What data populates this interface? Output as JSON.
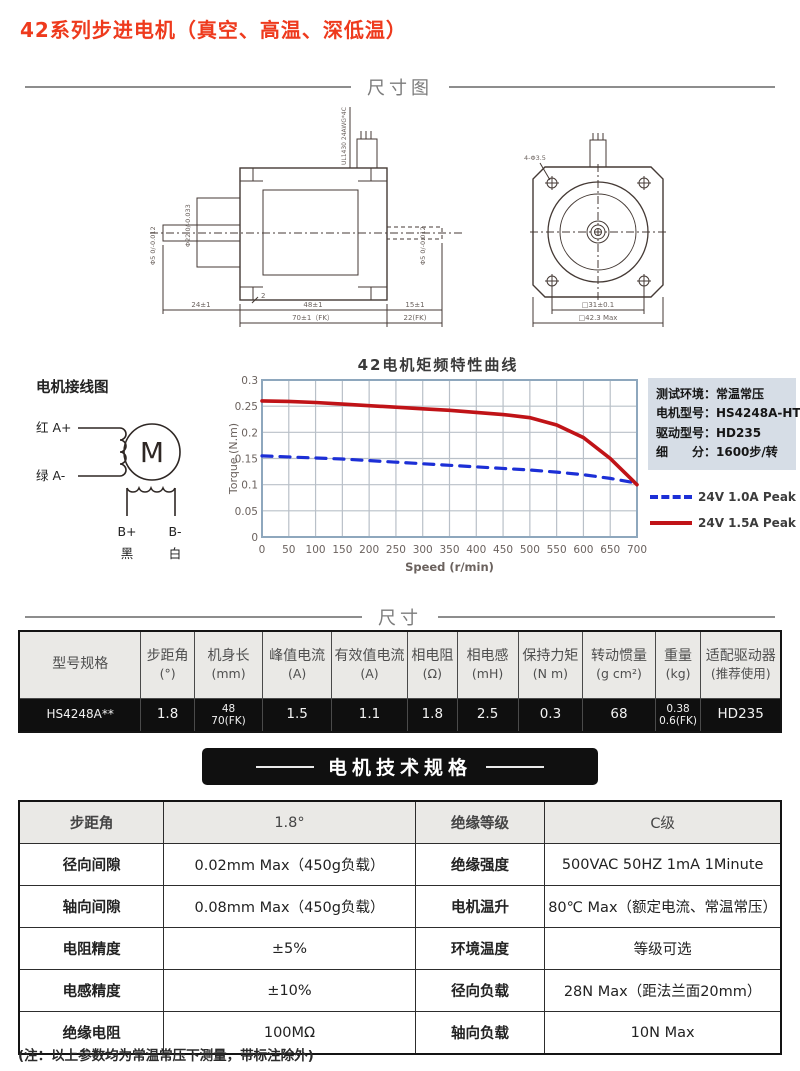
{
  "page_title": "42系列步进电机（真空、高温、深低温）",
  "accent_color": "#ee3a1d",
  "sections": {
    "dimension_diagram": "尺寸图",
    "dimensions": "尺寸",
    "specs": "电机技术规格"
  },
  "drawing": {
    "cable_label": "UL1430 24AWG*4C",
    "side_view": {
      "shaft_dia": "Φ5 0/-0.012",
      "pilot_dia": "Φ22 0/-0.033",
      "rear_shaft_dia": "Φ5 0/-0.012",
      "boss_len": "2",
      "front_shaft_len": "24±1",
      "body_len": "48±1",
      "body_len_fk": "70±1（FK）",
      "rear_shaft_len": "15±1",
      "rear_shaft_len_fk": "22(FK)"
    },
    "front_view": {
      "mounting_holes": "4-Φ3.5",
      "hole_pitch": "□31±0.1",
      "flange_size": "□42.3 Max"
    }
  },
  "wiring": {
    "title": "电机接线图",
    "a_plus": "红 A+",
    "a_minus": "绿 A-",
    "motor": "M",
    "b_plus": "B+",
    "b_minus": "B-",
    "black": "黑",
    "white": "白"
  },
  "info_panel": {
    "line1": "测试环境：常温常压",
    "line2": "电机型号：HS4248A-HT",
    "line3": "驱动型号：HD235",
    "line4": "细　　分：1600步/转"
  },
  "chart_data": {
    "type": "line",
    "title": "42电机矩频特性曲线",
    "xlabel": "Speed (r/min)",
    "ylabel": "Torque (N.m)",
    "xlim": [
      0,
      700
    ],
    "ylim": [
      0,
      0.3
    ],
    "x_ticks": [
      0,
      50,
      100,
      150,
      200,
      250,
      300,
      350,
      400,
      450,
      500,
      550,
      600,
      650,
      700
    ],
    "y_ticks": [
      0,
      0.05,
      0.1,
      0.15,
      0.2,
      0.25,
      0.3
    ],
    "grid": true,
    "legend_position": "right-bottom",
    "x": [
      0,
      50,
      100,
      150,
      200,
      250,
      300,
      350,
      400,
      450,
      500,
      550,
      600,
      650,
      700
    ],
    "series": [
      {
        "name": "24V 1.0A Peak",
        "color": "#1c2fd6",
        "style": "dashed",
        "values": [
          0.155,
          0.153,
          0.151,
          0.149,
          0.146,
          0.143,
          0.14,
          0.137,
          0.134,
          0.131,
          0.128,
          0.124,
          0.119,
          0.112,
          0.103
        ]
      },
      {
        "name": "24V 1.5A Peak",
        "color": "#c01317",
        "style": "solid",
        "values": [
          0.26,
          0.259,
          0.257,
          0.254,
          0.251,
          0.248,
          0.245,
          0.242,
          0.238,
          0.234,
          0.228,
          0.214,
          0.19,
          0.15,
          0.1
        ]
      }
    ]
  },
  "size_table": {
    "columns": [
      {
        "label": "型号规格",
        "unit": ""
      },
      {
        "label": "步距角",
        "unit": "(°)"
      },
      {
        "label": "机身长",
        "unit": "(mm)"
      },
      {
        "label": "峰值电流",
        "unit": "(A)"
      },
      {
        "label": "有效值电流",
        "unit": "(A)"
      },
      {
        "label": "相电阻",
        "unit": "(Ω)"
      },
      {
        "label": "相电感",
        "unit": "(mH)"
      },
      {
        "label": "保持力矩",
        "unit": "(N m)"
      },
      {
        "label": "转动惯量",
        "unit": "(g cm²)"
      },
      {
        "label": "重量",
        "unit": "(kg)"
      },
      {
        "label": "适配驱动器",
        "unit": "(推荐使用)"
      }
    ],
    "row": {
      "model": "HS4248A**",
      "step_angle": "1.8",
      "body_length": "48\n70(FK)",
      "peak_current": "1.5",
      "rms_current": "1.1",
      "phase_resistance": "1.8",
      "phase_inductance": "2.5",
      "holding_torque": "0.3",
      "rotor_inertia": "68",
      "weight": "0.38\n0.6(FK)",
      "driver": "HD235"
    }
  },
  "spec_table": {
    "rows": [
      {
        "l1": "步距角",
        "v1": "1.8°",
        "l2": "绝缘等级",
        "v2": "C级"
      },
      {
        "l1": "径向间隙",
        "v1": "0.02mm Max（450g负载）",
        "l2": "绝缘强度",
        "v2": "500VAC 50HZ 1mA 1Minute"
      },
      {
        "l1": "轴向间隙",
        "v1": "0.08mm Max（450g负载）",
        "l2": "电机温升",
        "v2": "80℃ Max（额定电流、常温常压）"
      },
      {
        "l1": "电阻精度",
        "v1": "±5%",
        "l2": "环境温度",
        "v2": "等级可选"
      },
      {
        "l1": "电感精度",
        "v1": "±10%",
        "l2": "径向负载",
        "v2": "28N Max（距法兰面20mm）"
      },
      {
        "l1": "绝缘电阻",
        "v1": "100MΩ",
        "l2": "轴向负载",
        "v2": "10N  Max"
      }
    ]
  },
  "footnote": "(注：以上参数均为常温常压下测量，带标注除外)"
}
